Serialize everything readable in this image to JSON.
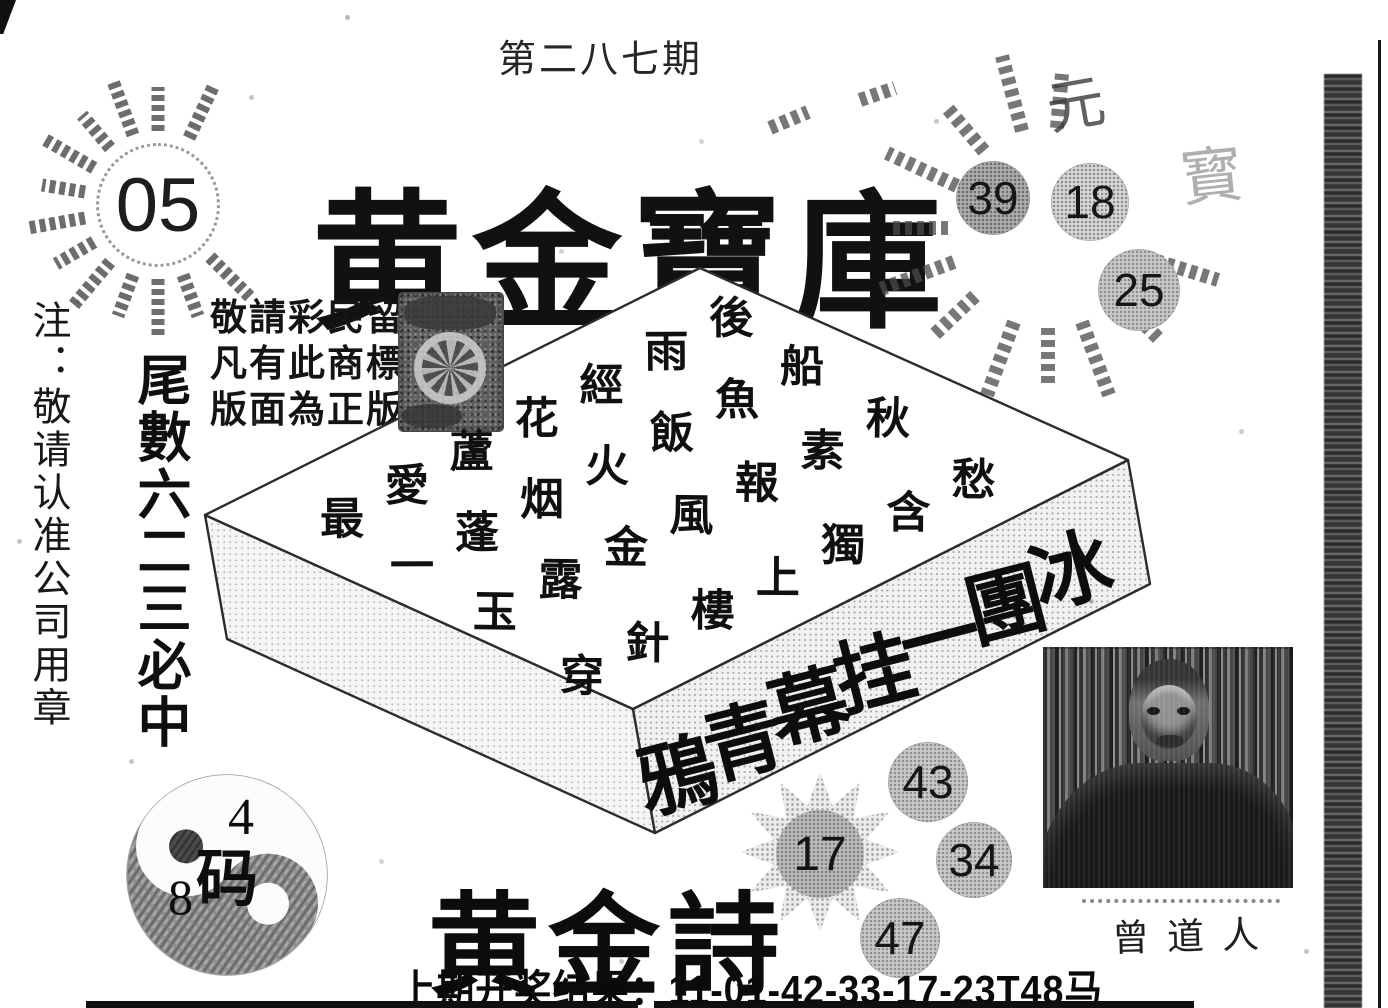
{
  "issue": {
    "label": "第二八七期"
  },
  "masthead": {
    "title": "黄金寶庫",
    "badge_number": "05"
  },
  "sunburst_right": {
    "numbers": [
      "39",
      "18",
      "25"
    ],
    "faint_chars": [
      "元",
      "寳"
    ]
  },
  "side_notes": {
    "seal_note": "注：敬请认准公司用章",
    "tail_note": "尾數六二三必中"
  },
  "trademark_notice": {
    "lines": [
      "敬請彩民留意",
      "凡有此商標的",
      "版面為正版!"
    ]
  },
  "box_poem": {
    "top_lines": [
      "最愛蘆花經雨後",
      "一蓬烟火飯魚船",
      "玉露金風報素秋",
      "穿針樓上獨含愁"
    ],
    "front_line": "鴉青幕挂一團冰"
  },
  "golden_poem": {
    "title": "黄金詩"
  },
  "picks": {
    "star_number": "17",
    "circle_numbers": [
      "43",
      "34",
      "47"
    ]
  },
  "taiji": {
    "top_number": "4",
    "center_char": "码",
    "left_number": "8"
  },
  "portrait": {
    "caption": "曾道人"
  },
  "footer": {
    "last_result": "上期开奖结果：11-01-42-33-17-23T48马"
  },
  "colors": {
    "ink": "#1a1a1a",
    "halftone_gray": "#c9c9c9",
    "paper": "#ffffff"
  }
}
